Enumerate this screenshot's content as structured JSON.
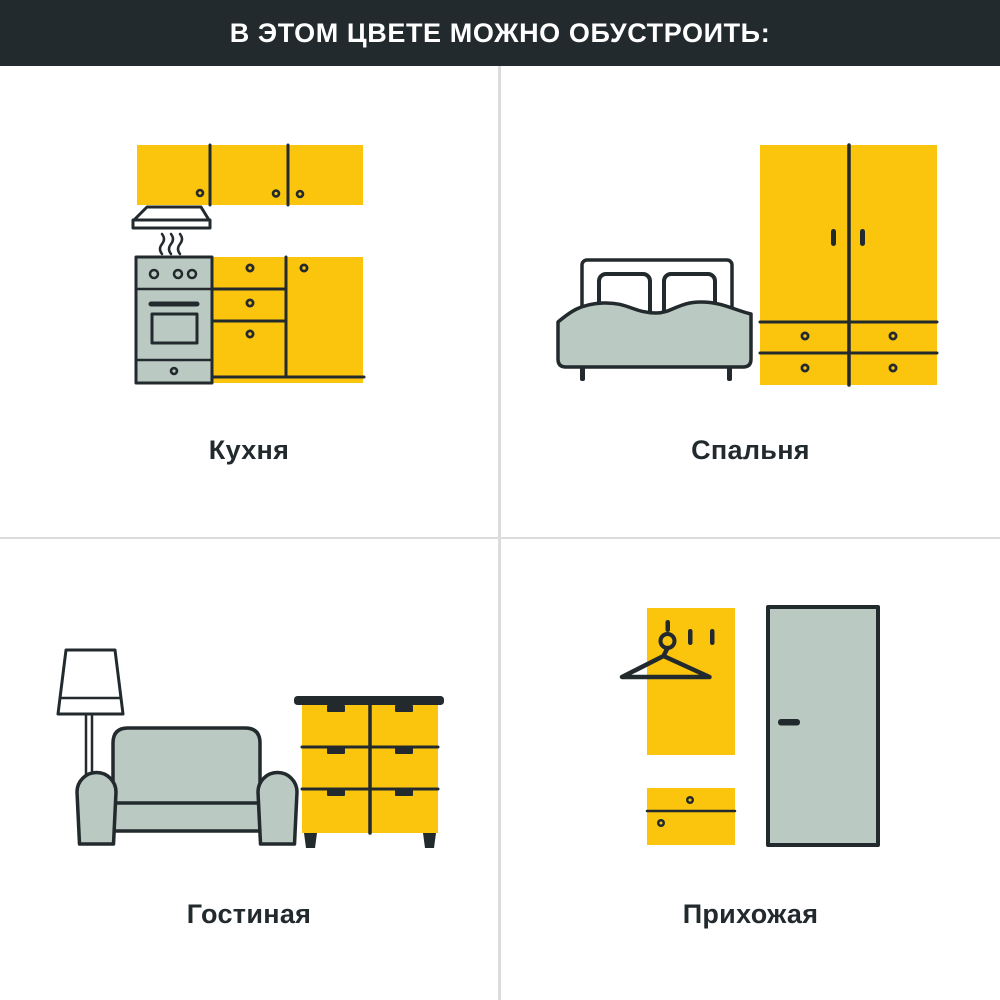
{
  "header": {
    "title": "В ЭТОМ ЦВЕТЕ МОЖНО ОБУСТРОИТЬ:"
  },
  "colors": {
    "accent": "#FBC50E",
    "sage": "#BAC9C1",
    "ink": "#232A2D",
    "divider": "#DCDCDC",
    "bg": "#FFFFFF"
  },
  "sections": [
    {
      "id": "kitchen",
      "label": "Кухня",
      "icon": "kitchen-set-icon"
    },
    {
      "id": "bedroom",
      "label": "Спальня",
      "icon": "bed-and-wardrobe-icon"
    },
    {
      "id": "living-room",
      "label": "Гостиная",
      "icon": "sofa-lamp-dresser-icon"
    },
    {
      "id": "hallway",
      "label": "Прихожая",
      "icon": "coat-rack-and-door-icon"
    }
  ]
}
